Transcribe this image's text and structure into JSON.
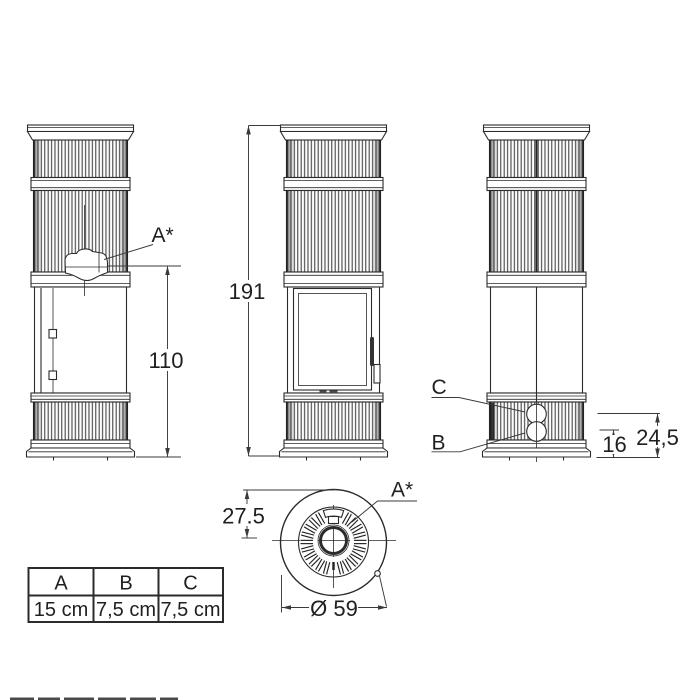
{
  "drawing": {
    "title": "stove-dimension-drawing",
    "dimensions": {
      "overall_height": "191",
      "flue_height": "110",
      "outlet_b": "16",
      "outlet_c": "24,5",
      "top_offset": "27.5",
      "diameter": "Ø 59"
    },
    "labels": {
      "flue_side": "A*",
      "flue_top": "A*",
      "outlet_c": "C",
      "outlet_b": "B"
    },
    "table": {
      "headers": [
        "A",
        "B",
        "C"
      ],
      "values": [
        "15 cm",
        "7,5 cm",
        "7,5 cm"
      ]
    }
  }
}
